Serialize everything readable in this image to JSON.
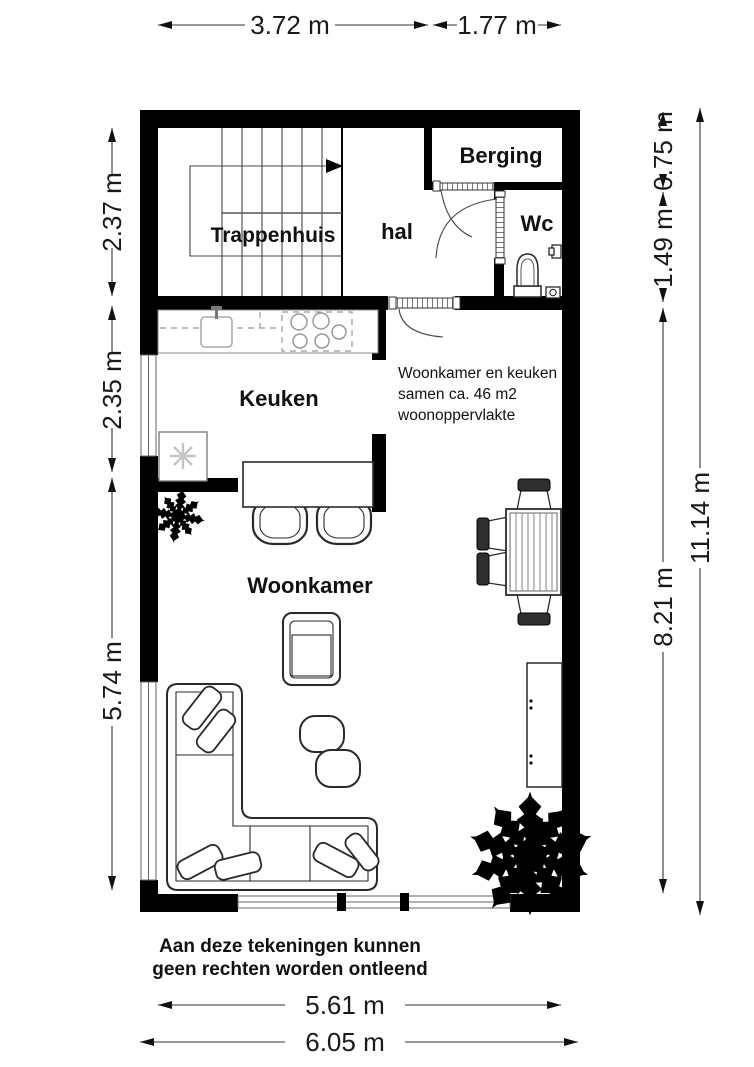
{
  "floorplan": {
    "colors": {
      "wall": "#000000",
      "background": "#ffffff",
      "outline": "#2a2a2a",
      "light_outline": "#999999",
      "text": "#111111"
    },
    "rooms": {
      "trappenhuis": "Trappenhuis",
      "hal": "hal",
      "berging": "Berging",
      "wc": "Wc",
      "keuken": "Keuken",
      "woonkamer": "Woonkamer"
    },
    "note": {
      "line1": "Woonkamer en keuken",
      "line2": "samen ca. 46 m2",
      "line3": "woonoppervlakte"
    },
    "disclaimer": {
      "line1": "Aan deze tekeningen kunnen",
      "line2": "geen rechten worden ontleend"
    },
    "dimensions": {
      "top": [
        {
          "label": "3.72 m"
        },
        {
          "label": "1.77 m"
        }
      ],
      "bottom": [
        {
          "label": "5.61 m"
        },
        {
          "label": "6.05 m"
        }
      ],
      "left": [
        {
          "label": "2.37 m"
        },
        {
          "label": "2.35 m"
        },
        {
          "label": "5.74 m"
        }
      ],
      "right": [
        {
          "label": "0.75 m"
        },
        {
          "label": "1.49 m"
        },
        {
          "label": "8.21 m"
        },
        {
          "label": "11.14 m"
        }
      ]
    }
  }
}
